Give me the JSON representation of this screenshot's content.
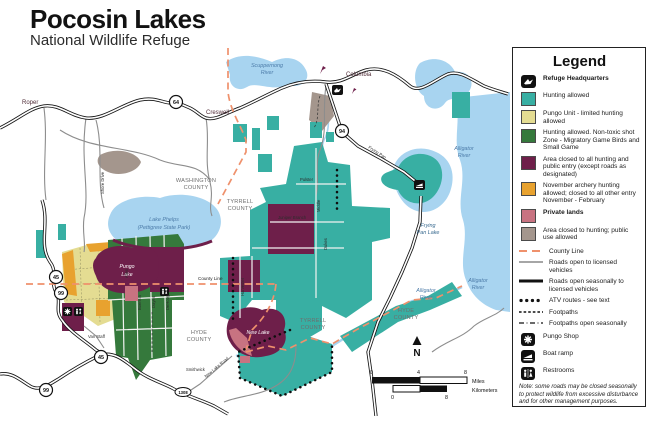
{
  "title": {
    "main": "Pocosin Lakes",
    "sub": "National Wildlife Refuge"
  },
  "colors": {
    "teal": "#38AFA3",
    "pale_yellow": "#E4DC92",
    "green": "#35793C",
    "maroon": "#6E1F4A",
    "orange": "#E8A22F",
    "pink": "#C87381",
    "taupe": "#A4968D",
    "water": "#A8D4F0",
    "county_line": "#EF916C"
  },
  "legend": {
    "heading": "Legend",
    "hq_label": "Refuge Headquarters",
    "areas": [
      {
        "color": "#38AFA3",
        "label": "Hunting allowed"
      },
      {
        "color": "#E4DC92",
        "label": "Pungo Unit - limited hunting allowed"
      },
      {
        "color": "#35793C",
        "label": "Hunting allowed.  Non-toxic shot Zone - Migratory Game Birds and Small Game"
      },
      {
        "color": "#6E1F4A",
        "label": "Area closed to all hunting and public entry (except roads as designated)"
      },
      {
        "color": "#E8A22F",
        "label": "November archery hunting allowed; closed to all other entry November - February"
      },
      {
        "color": "#C87381",
        "label": "Private lands"
      },
      {
        "color": "#A4968D",
        "label": "Area closed to hunting; public use allowed"
      }
    ],
    "lines": [
      {
        "label": "County Line"
      },
      {
        "label": "Roads open to licensed vehicles"
      },
      {
        "label": "Roads open seasonally to licensed vehicles"
      },
      {
        "label": "ATV routes - see text"
      },
      {
        "label": "Footpaths"
      },
      {
        "label": "Footpaths open seasonally"
      }
    ],
    "points": [
      {
        "label": "Pungo Shop"
      },
      {
        "label": "Boat ramp"
      },
      {
        "label": "Restrooms"
      }
    ],
    "note": "Note: some roads may be closed seasonally to protect wildlife from excessive disturbance and for other management purposes."
  },
  "map": {
    "towns": {
      "roper": "Roper",
      "creswell": "Creswell",
      "columbia": "Columbia"
    },
    "counties": {
      "washington": [
        "WASHINGTON",
        "COUNTY"
      ],
      "tyrrell": [
        "TYRRELL",
        "COUNTY"
      ],
      "hyde": [
        "HYDE",
        "COUNTY"
      ]
    },
    "water_labels": {
      "scuppernong": [
        "Scuppernong",
        "River"
      ],
      "alligator": [
        "Alligator",
        "River"
      ],
      "lake_phelps": [
        "Lake Phelps",
        "(Pettigrew State Park)"
      ],
      "frying_pan_lake": [
        "Frying",
        "Pan Lake"
      ]
    },
    "lake_labels": {
      "pungo": [
        "Pungo",
        "Lake"
      ],
      "new_lake": "New Lake"
    },
    "road_labels": {
      "county_line": "County Line",
      "juniper_branch": "Juniper Branch",
      "new_lake_road": "New Lake Road",
      "smithwick": "Smithwick",
      "van_staff": "Van Staff",
      "frying_pan": "Frying Pan",
      "shore_drive": "Shore Drive",
      "harvester": "Harvester",
      "allen": "Allen",
      "boerma": "Boerma",
      "dayes": "Dayes",
      "dehoog": "DeHoog",
      "dukes": "Dukes",
      "pulster": "Pulster",
      "middle": "Middle"
    },
    "shields": {
      "s64": "64",
      "s94": "94",
      "s45": "45",
      "s99": "99",
      "s1308": "1308"
    },
    "north": "N",
    "scale": {
      "miles_ticks": [
        "0",
        "4",
        "8"
      ],
      "miles_label": "Miles",
      "km_ticks": [
        "0",
        "8"
      ],
      "km_label": "Kilometers"
    }
  }
}
